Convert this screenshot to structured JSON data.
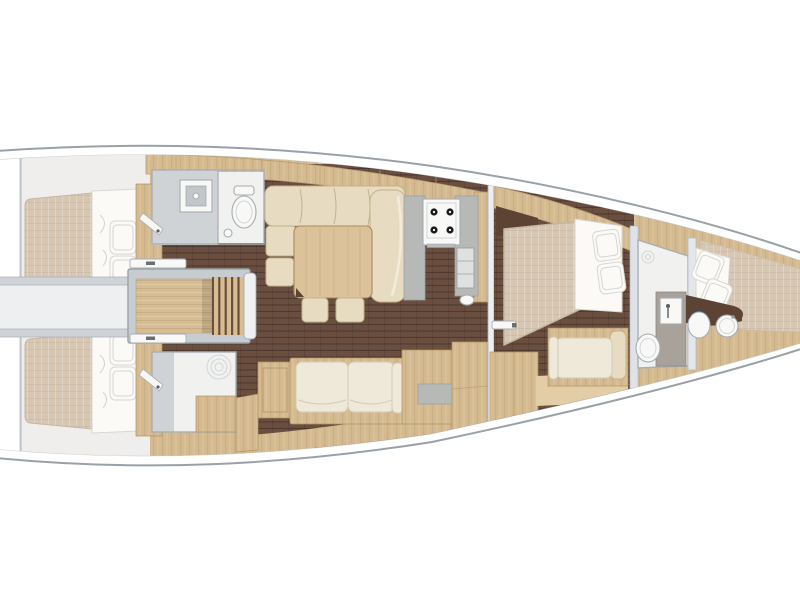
{
  "meta": {
    "figure_type": "yacht-interior-floor-plan",
    "view": "top-down",
    "orientation": "bow-right-stern-left",
    "visible_text": ""
  },
  "palette": {
    "pageBg": "#ffffff",
    "hullStroke": "#99a1a8",
    "deckLine": "#c7ccd1",
    "wood": "#d5ba90",
    "woodEdge": "#b3935f",
    "tableWood": "#dcc29b",
    "floor": "#6a4e3f",
    "mattress": "#d7c6b2",
    "linen": "#fbfaf7",
    "linenEdge": "#d9d7d0",
    "cushion": "#e7dcc2",
    "cushionEdge": "#c3b28b",
    "cream": "#efe9da",
    "creamEdge": "#d3cab4",
    "counter": "#b6b9b5",
    "wall": "#cfd3d7",
    "wallStroke": "#a8aeb4",
    "bathGray": "#d0d3d5",
    "bathWhite": "#f1f2f0",
    "fixture": "#f8f8f6",
    "fixtureStroke": "#a5acb2",
    "pillar": "#a9a29a",
    "darkWood": "#5d4334",
    "ramp": "#d8bd92",
    "corridor": "#edeff0",
    "cabinBg": "#efeeec"
  },
  "rooms": [
    {
      "id": "aft-cabin-port",
      "label": "aft double cabin (port)"
    },
    {
      "id": "aft-cabin-starboard",
      "label": "aft double cabin (starboard)"
    },
    {
      "id": "aft-heads-port",
      "label": "aft heads with shower and toilet"
    },
    {
      "id": "aft-shower-starboard",
      "label": "aft shower room"
    },
    {
      "id": "companionway",
      "label": "companionway steps / engine box"
    },
    {
      "id": "saloon",
      "label": "saloon with U-sofa, table and stools"
    },
    {
      "id": "galley",
      "label": "galley with 4-burner stove"
    },
    {
      "id": "nav-station",
      "label": "chart table / nav seat"
    },
    {
      "id": "forward-cabin",
      "label": "forward owner cabin"
    },
    {
      "id": "forward-heads",
      "label": "forward heads with shower"
    },
    {
      "id": "bow-cabin",
      "label": "bow cabin with berth, toilet and sink"
    }
  ]
}
